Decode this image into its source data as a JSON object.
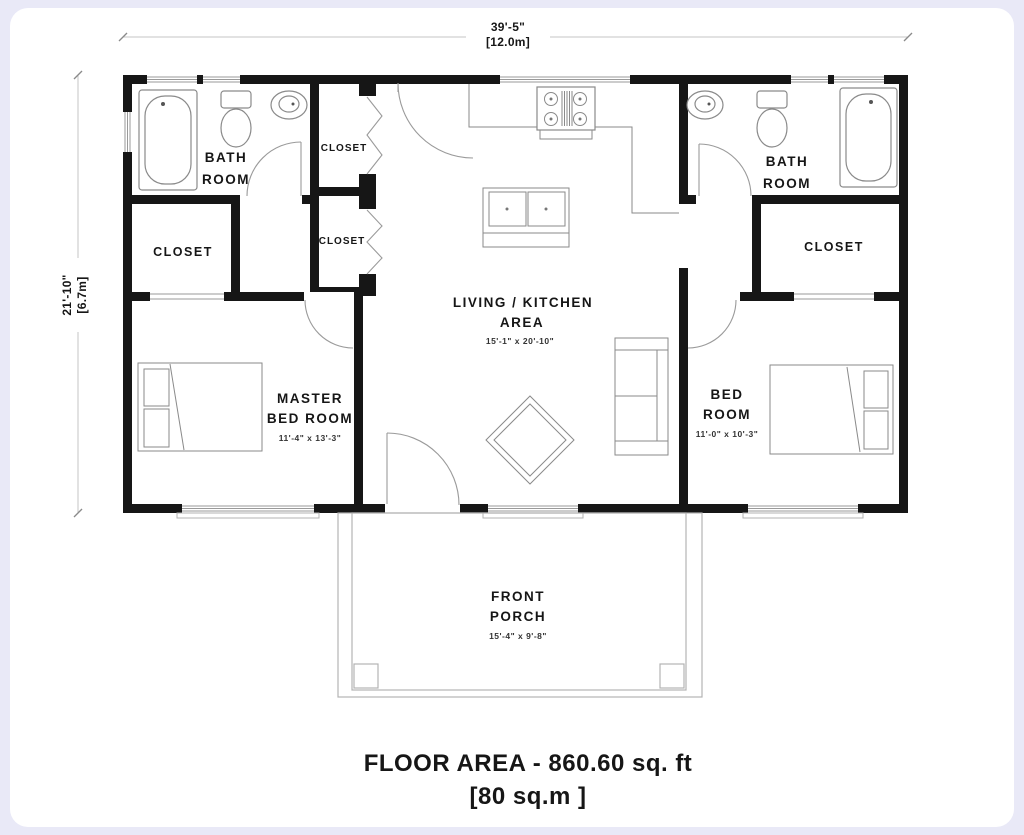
{
  "caption": {
    "line1": "FLOOR AREA - 860.60 sq. ft",
    "line2": "[80 sq.m ]"
  },
  "dimensions": {
    "overall_width_ft": "39'-5\"",
    "overall_width_m": "[12.0m]",
    "overall_depth_ft": "21'-10\"",
    "overall_depth_m": "[6.7m]"
  },
  "rooms": {
    "bath_left": {
      "label1": "BATH",
      "label2": "ROOM"
    },
    "closet_left": {
      "label": "CLOSET"
    },
    "closet_mid_top": {
      "label": "CLOSET"
    },
    "closet_mid_bottom": {
      "label": "CLOSET"
    },
    "living_kitchen": {
      "label1": "LIVING / KITCHEN",
      "label2": "AREA",
      "size": "15'-1\" x 20'-10\""
    },
    "master_bedroom": {
      "label1": "MASTER",
      "label2": "BED ROOM",
      "size": "11'-4\" x 13'-3\""
    },
    "bath_right": {
      "label1": "BATH",
      "label2": "ROOM"
    },
    "closet_right": {
      "label": "CLOSET"
    },
    "bedroom": {
      "label1": "BED",
      "label2": "ROOM",
      "size": "11'-0\" x 10'-3\""
    },
    "front_porch": {
      "label1": "FRONT",
      "label2": "PORCH",
      "size": "15'-4\" x 9'-8\""
    }
  },
  "colors": {
    "background": "#e9e9f7",
    "card": "#ffffff",
    "wall": "#161616",
    "thin_line": "#9a9a9a",
    "text": "#161616"
  }
}
